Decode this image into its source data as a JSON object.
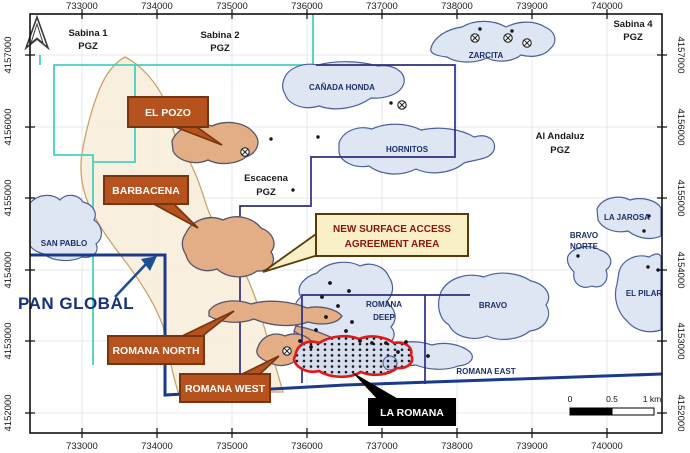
{
  "map": {
    "axis": {
      "eastings": [
        "733000",
        "734000",
        "735000",
        "736000",
        "737000",
        "738000",
        "739000",
        "740000"
      ],
      "northings": [
        "4157000",
        "4156000",
        "4155000",
        "4154000",
        "4153000",
        "4152000"
      ]
    },
    "permits": [
      {
        "name": "Sabina 1",
        "zone": "PGZ"
      },
      {
        "name": "Sabina 2",
        "zone": "PGZ"
      },
      {
        "name": "Sabina 4",
        "zone": "PGZ"
      },
      {
        "name": "Al Andaluz",
        "zone": "PGZ"
      },
      {
        "name": "Escacena",
        "zone": "PGZ"
      }
    ],
    "areas": {
      "zarcita": "ZARCITA",
      "canada_honda": "CAÑADA HONDA",
      "hornitos": "HORNITOS",
      "san_pablo": "SAN PABLO",
      "la_jarosa": "LA JAROSA",
      "bravo_norte_line1": "BRAVO",
      "bravo_norte_line2": "NORTE",
      "bravo": "BRAVO",
      "el_pilar": "EL PILAR",
      "romana_deep_line1": "ROMANA",
      "romana_deep_line2": "DEEP",
      "romana_east": "ROMANA EAST"
    },
    "callouts": {
      "el_pozo": "EL POZO",
      "barbacena": "BARBACENA",
      "romana_north": "ROMANA NORTH",
      "romana_west": "ROMANA WEST",
      "la_romana": "LA ROMANA"
    },
    "annotation": {
      "line1": "NEW SURFACE ACCESS",
      "line2": "AGREEMENT AREA"
    },
    "company_label": "PAN GLOBAL",
    "scale_bar": {
      "start": "0",
      "mid": "0.5",
      "end": "1 km"
    },
    "symbols": {
      "north_arrow": "chevron-north-arrow",
      "mine": "circle-with-x",
      "drill_hole": "small-black-dot"
    },
    "colors": {
      "teal_boundary": "#45d0c2",
      "navy_boundary": "#2e2e7e",
      "property_boundary": "#1b3a8c",
      "prospect_fill": "#dee5f3",
      "prospect_stroke": "#49609c",
      "surface_area_fill": "#f8ecd9",
      "surface_area_stroke": "#c9a36a",
      "deposit_fill": "#e3ae86",
      "callout_bg": "#b5521d",
      "callout_border": "#76350e",
      "agreement_bg": "#faf0c8",
      "agreement_text": "#8b1509",
      "la_romana_outline": "#e01818",
      "company_text": "#15307d"
    }
  }
}
